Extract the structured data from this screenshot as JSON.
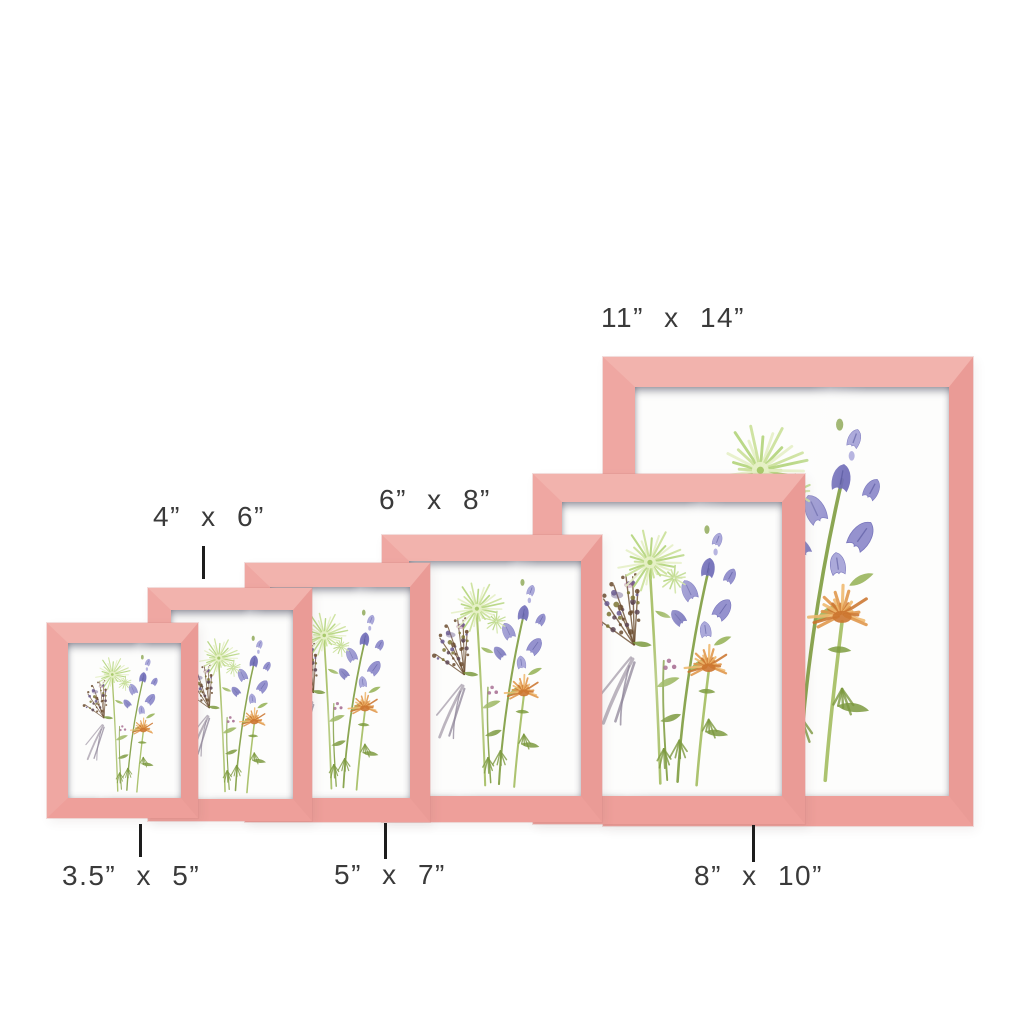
{
  "page": {
    "background": "#ffffff",
    "subject": "pink wooden picture frames size comparison"
  },
  "colors": {
    "frame_pink": "#f0a8a3",
    "frame_pink_light": "#f2b3ad",
    "frame_pink_dark": "#ea9b96",
    "mat_white": "#fdfdfc",
    "label_text": "#3a3a3a",
    "tick_line": "#1d1d1d"
  },
  "sizes": [
    {
      "id": "3.5x5",
      "label": "3.5” x 5”",
      "label_position": "below"
    },
    {
      "id": "4x6",
      "label": "4” x 6”",
      "label_position": "above"
    },
    {
      "id": "5x7",
      "label": "5” x 7”",
      "label_position": "below"
    },
    {
      "id": "6x8",
      "label": "6” x 8”",
      "label_position": "above"
    },
    {
      "id": "8x10",
      "label": "8” x 10”",
      "label_position": "below"
    },
    {
      "id": "11x14",
      "label": "11” x 14”",
      "label_position": "above"
    }
  ],
  "artwork": {
    "description": "watercolor wildflower bouquet print",
    "elements": [
      "green spider chrysanthemum",
      "purple bellflowers",
      "orange chrysanthemum",
      "dark seed twigs",
      "gray feathery foliage",
      "green stems and leaves"
    ]
  }
}
